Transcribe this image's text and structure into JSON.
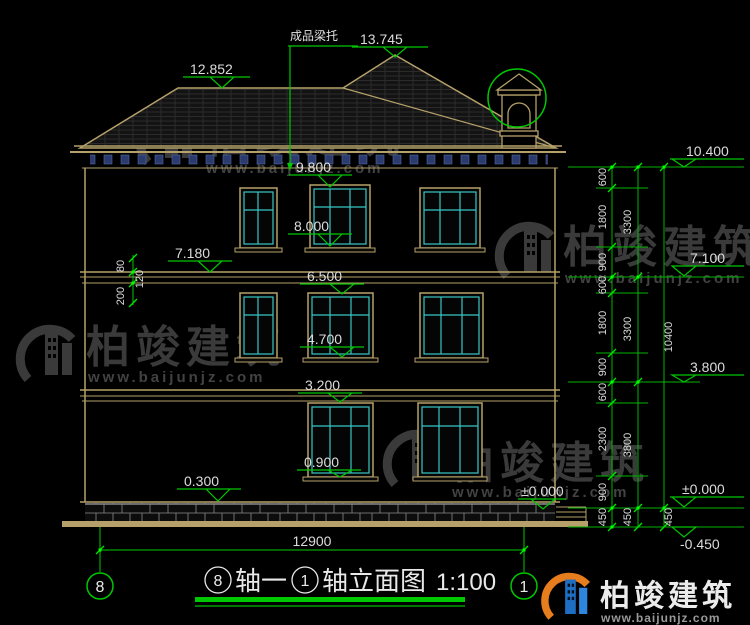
{
  "labels": {
    "roof_note": "成品梁托"
  },
  "elevations": {
    "apex": "13.745",
    "ridge": "12.852",
    "third_head": "9.800",
    "third_sill": "8.000",
    "band_top": "7.180",
    "second_head": "6.500",
    "second_sill": "4.700",
    "first_head": "3.200",
    "first_sill": "0.900",
    "plinth_top": "0.300",
    "zero_right": "±0.000"
  },
  "left_dims": [
    "80",
    "120",
    "200"
  ],
  "right_dims": {
    "chain1": [
      "600",
      "1800",
      "900",
      "600",
      "1800",
      "900",
      "600",
      "2300",
      "900",
      "450"
    ],
    "chain2": [
      "3300",
      "3300",
      "3800",
      "450"
    ],
    "chain3": [
      "10400",
      "450"
    ],
    "markers": {
      "top": "10.400",
      "floor2": "7.100",
      "floor1": "3.800",
      "zero": "±0.000",
      "minus": "-0.450"
    }
  },
  "bottom": {
    "total_width": "12900",
    "axis_left": "8",
    "axis_right": "1"
  },
  "title": {
    "axis_from": "8",
    "mid": "轴一",
    "axis_to": "1",
    "suffix": "轴立面图",
    "scale": "1:100"
  },
  "watermark": {
    "name": "柏竣建筑",
    "url": "www.baijunjz.com"
  },
  "colors": {
    "line_green": "#00c800",
    "cad_tan": "#b5a169",
    "window_cyan": "#38c6c6",
    "dentil_blue": "#2c3b6e",
    "text_white": "#dcdcdc",
    "watermark_grey": "#3a3a3a",
    "logo_blue": "#1e6fc4",
    "logo_orange": "#e87d1e"
  }
}
